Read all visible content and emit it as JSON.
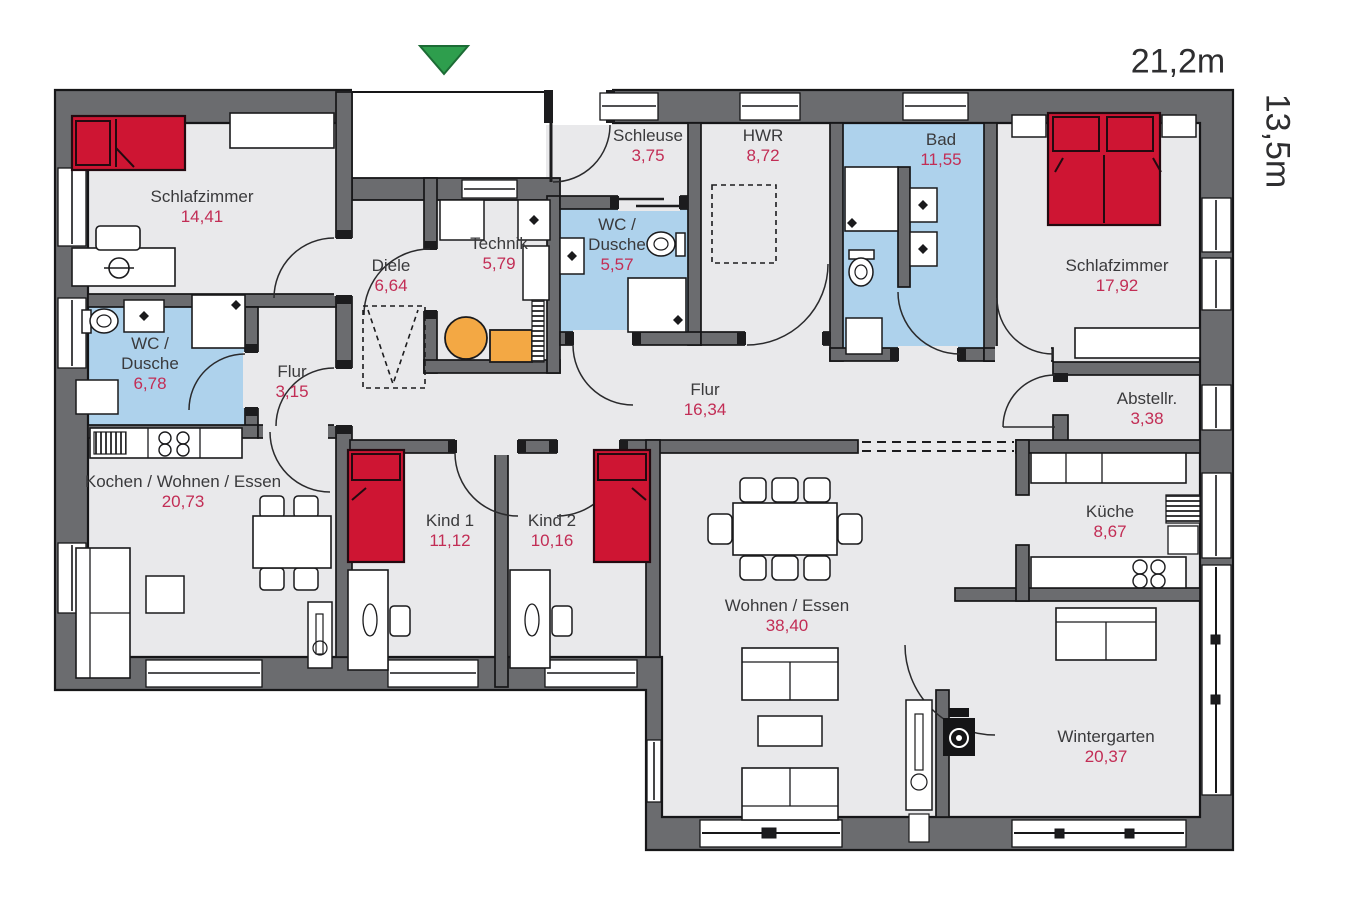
{
  "dimensions": {
    "width": "21,2m",
    "height": "13,5m"
  },
  "entrance": {
    "marker": "entrance-arrow",
    "color": "#2e9e4d"
  },
  "colors": {
    "wall": "#6b6c6f",
    "floor": "#e9e9eb",
    "bathroom_floor": "#aed2ec",
    "bed": "#ce1533",
    "equipment_orange": "#f3a844",
    "room_name_text": "#3a3a3c",
    "area_value_text": "#c22d55",
    "entrance_marker": "#2e9e4d"
  },
  "rooms": [
    {
      "id": "schlafzimmer-left",
      "name": "Schlafzimmer",
      "area": "14,41"
    },
    {
      "id": "wc-dusche-left",
      "name": "WC / Dusche",
      "area": "6,78"
    },
    {
      "id": "flur-left",
      "name": "Flur",
      "area": "3,15"
    },
    {
      "id": "diele",
      "name": "Diele",
      "area": "6,64"
    },
    {
      "id": "technik",
      "name": "Technik",
      "area": "5,79"
    },
    {
      "id": "schleuse",
      "name": "Schleuse",
      "area": "3,75"
    },
    {
      "id": "wc-dusche-mid",
      "name": "WC / Dusche",
      "area": "5,57"
    },
    {
      "id": "hwr",
      "name": "HWR",
      "area": "8,72"
    },
    {
      "id": "bad",
      "name": "Bad",
      "area": "11,55"
    },
    {
      "id": "schlafzimmer-right",
      "name": "Schlafzimmer",
      "area": "17,92"
    },
    {
      "id": "abstellraum",
      "name": "Abstellr.",
      "area": "3,38"
    },
    {
      "id": "flur-main",
      "name": "Flur",
      "area": "16,34"
    },
    {
      "id": "kochen-wohnen-essen",
      "name": "Kochen / Wohnen / Essen",
      "area": "20,73"
    },
    {
      "id": "kind-1",
      "name": "Kind 1",
      "area": "11,12"
    },
    {
      "id": "kind-2",
      "name": "Kind 2",
      "area": "10,16"
    },
    {
      "id": "wohnen-essen",
      "name": "Wohnen / Essen",
      "area": "38,40"
    },
    {
      "id": "kueche",
      "name": "Küche",
      "area": "8,67"
    },
    {
      "id": "wintergarten",
      "name": "Wintergarten",
      "area": "20,37"
    }
  ]
}
